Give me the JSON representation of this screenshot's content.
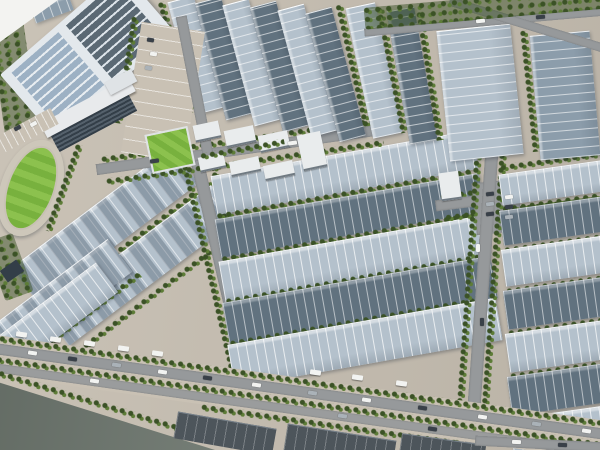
{
  "scene": {
    "title": "aerial-render-industrial-park",
    "description": "3D bird's-eye rendering of a large logistics/industrial park: rows of long warehouses with light and dark blue-gray paneled roofs, tree-lined internal roads, a running track with green infield, a small lawn and office campus at the upper left, a canal-side dark ground strip at the lower left, and perimeter roads with cars and trucks."
  },
  "colors": {
    "bg": "#c6beb1",
    "apron": "#c9c1b4",
    "roof_light": "#b4c1cc",
    "roof_dark": "#61727f",
    "roof_mid": "#8c9dab",
    "tree": "#3b5226",
    "tree2": "#5d7c37",
    "grass": "#78b13e",
    "grass_light": "#8cc14e",
    "track": "#cdc7ba",
    "road": "#96999b",
    "water": "#6d766e",
    "facade_dark": "#333e48",
    "white_bldg": "#e9eced",
    "panel_light": "#9db1c4",
    "panel_dark": "#5b6974",
    "dark_bottom": "#4d555b",
    "car_white": "#f2f3f1",
    "car_dark": "#394048",
    "car_silver": "#aab2b8",
    "corner": "#f3f3f1"
  }
}
